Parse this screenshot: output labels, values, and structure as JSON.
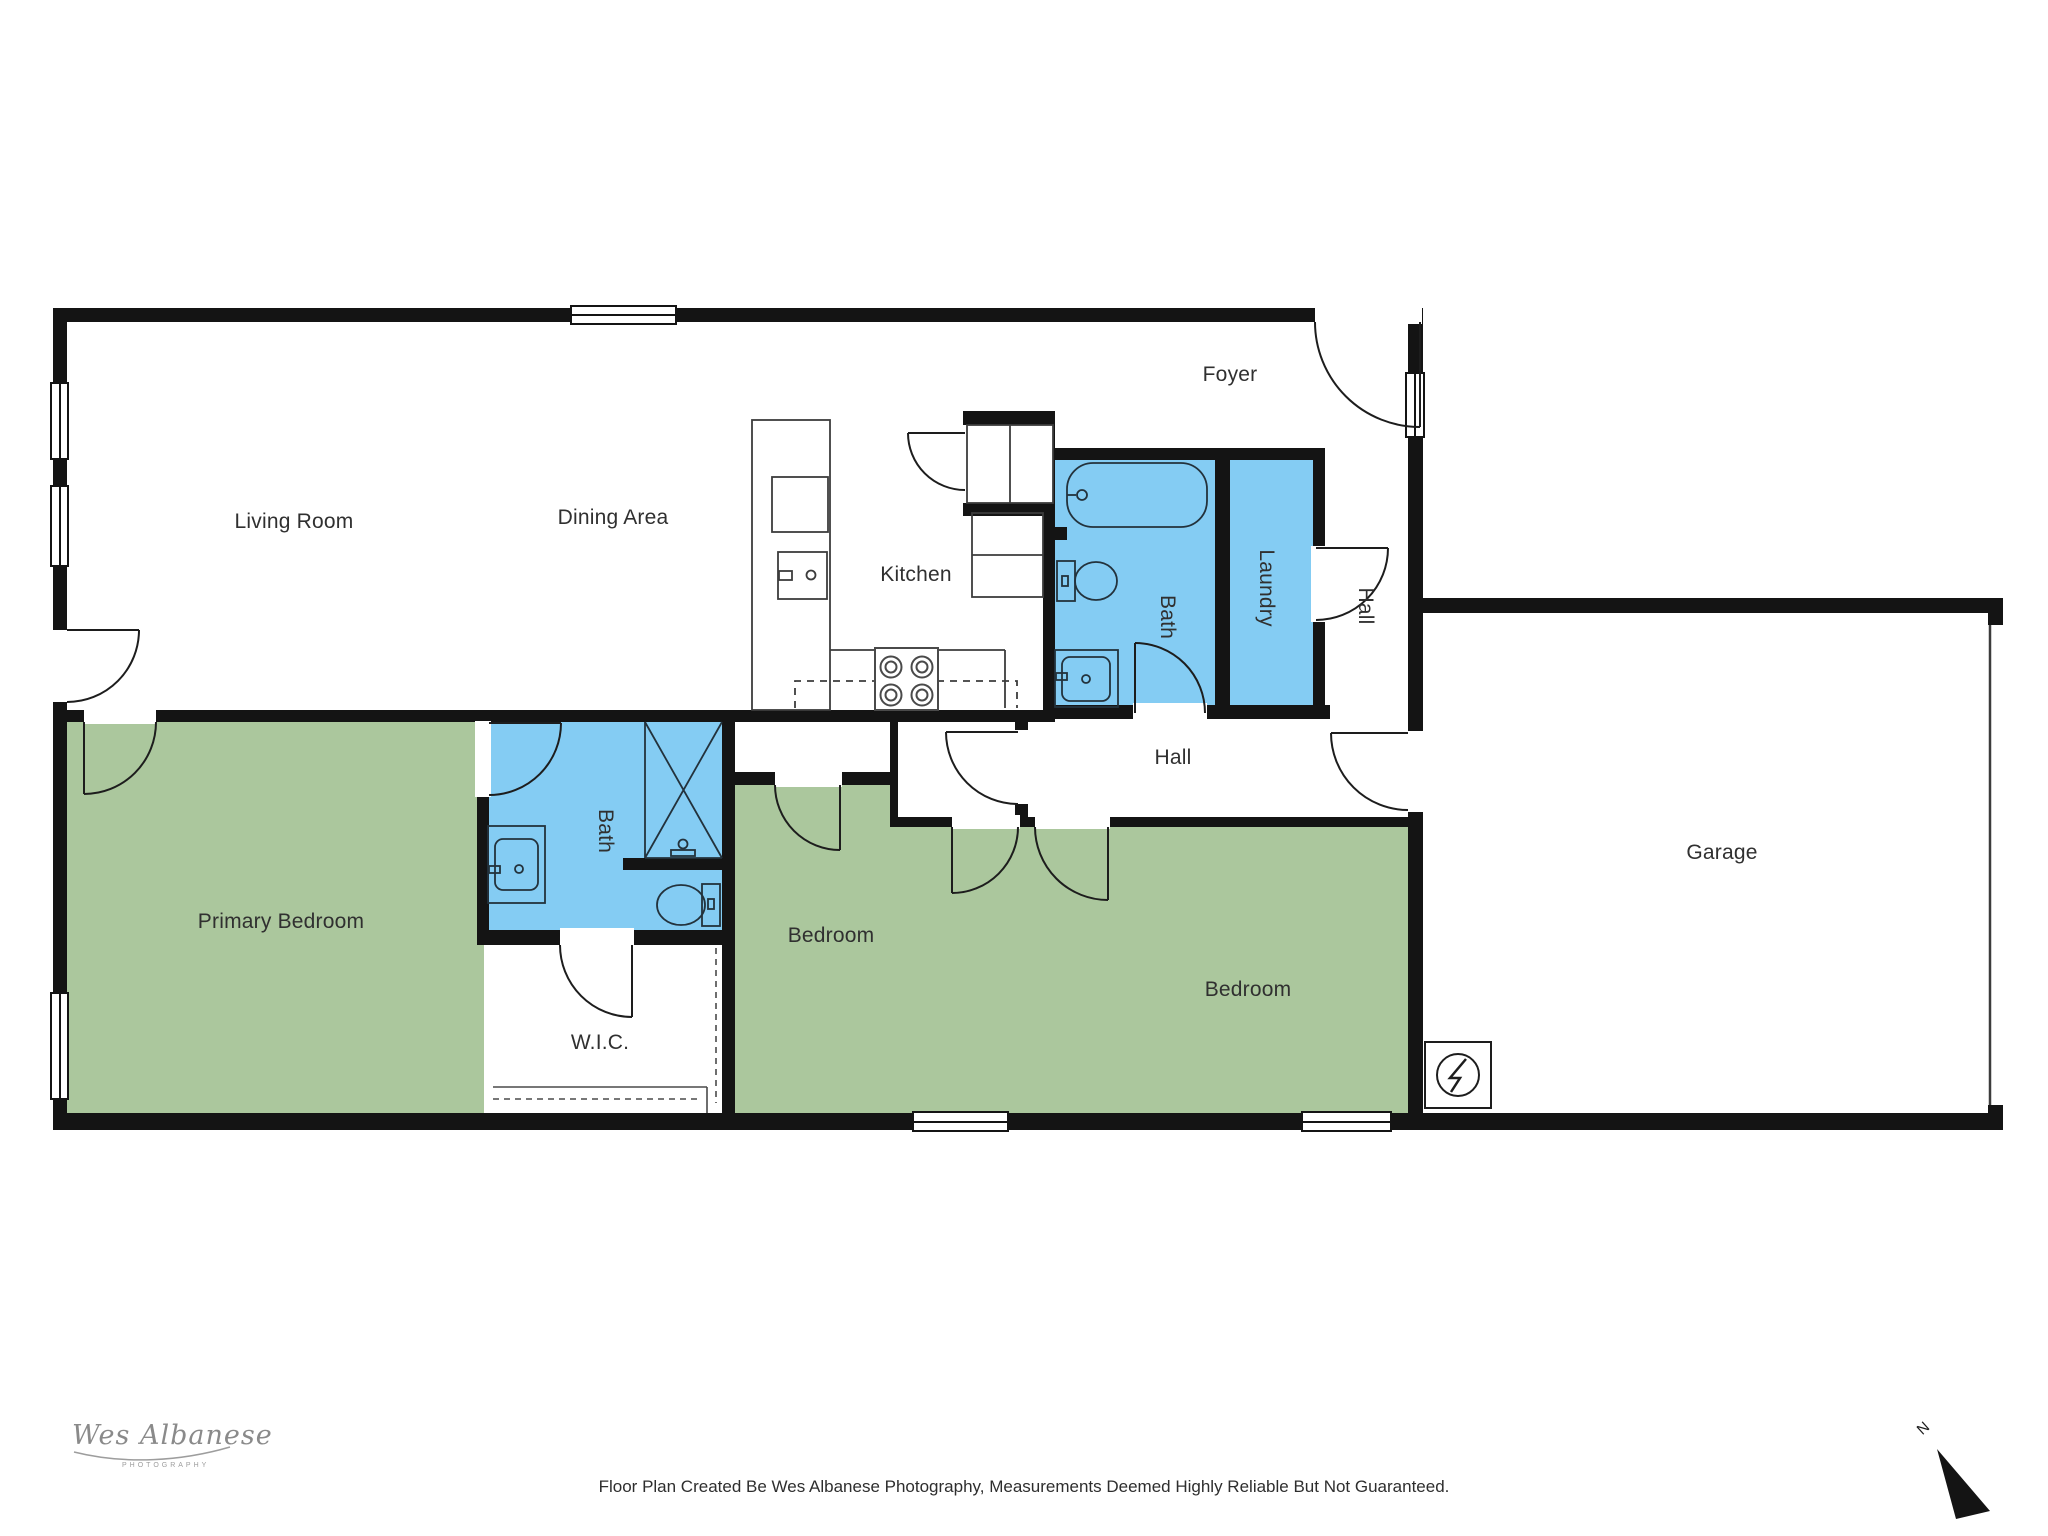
{
  "rooms": {
    "living": {
      "label": "Living Room"
    },
    "dining": {
      "label": "Dining Area"
    },
    "kitchen": {
      "label": "Kitchen"
    },
    "foyer": {
      "label": "Foyer"
    },
    "bath_upper": {
      "label": "Bath"
    },
    "laundry": {
      "label": "Laundry"
    },
    "hall_corridor": {
      "label": "Hall"
    },
    "hall": {
      "label": "Hall"
    },
    "primary_bedroom": {
      "label": "Primary Bedroom"
    },
    "bath_lower": {
      "label": "Bath"
    },
    "wic": {
      "label": "W.I.C."
    },
    "bedroom_middle": {
      "label": "Bedroom"
    },
    "bedroom_right": {
      "label": "Bedroom"
    },
    "garage": {
      "label": "Garage"
    }
  },
  "footer": {
    "disclaimer": "Floor Plan Created Be Wes Albanese Photography, Measurements Deemed Highly Reliable But Not Guaranteed."
  },
  "logo": {
    "script": "Wes Albanese",
    "subtitle": "PHOTOGRAPHY"
  },
  "compass": {
    "north": "N"
  },
  "colors": {
    "room_green": "#abc79d",
    "room_blue": "#84ccf3",
    "wall": "#141414",
    "label": "#303030"
  }
}
